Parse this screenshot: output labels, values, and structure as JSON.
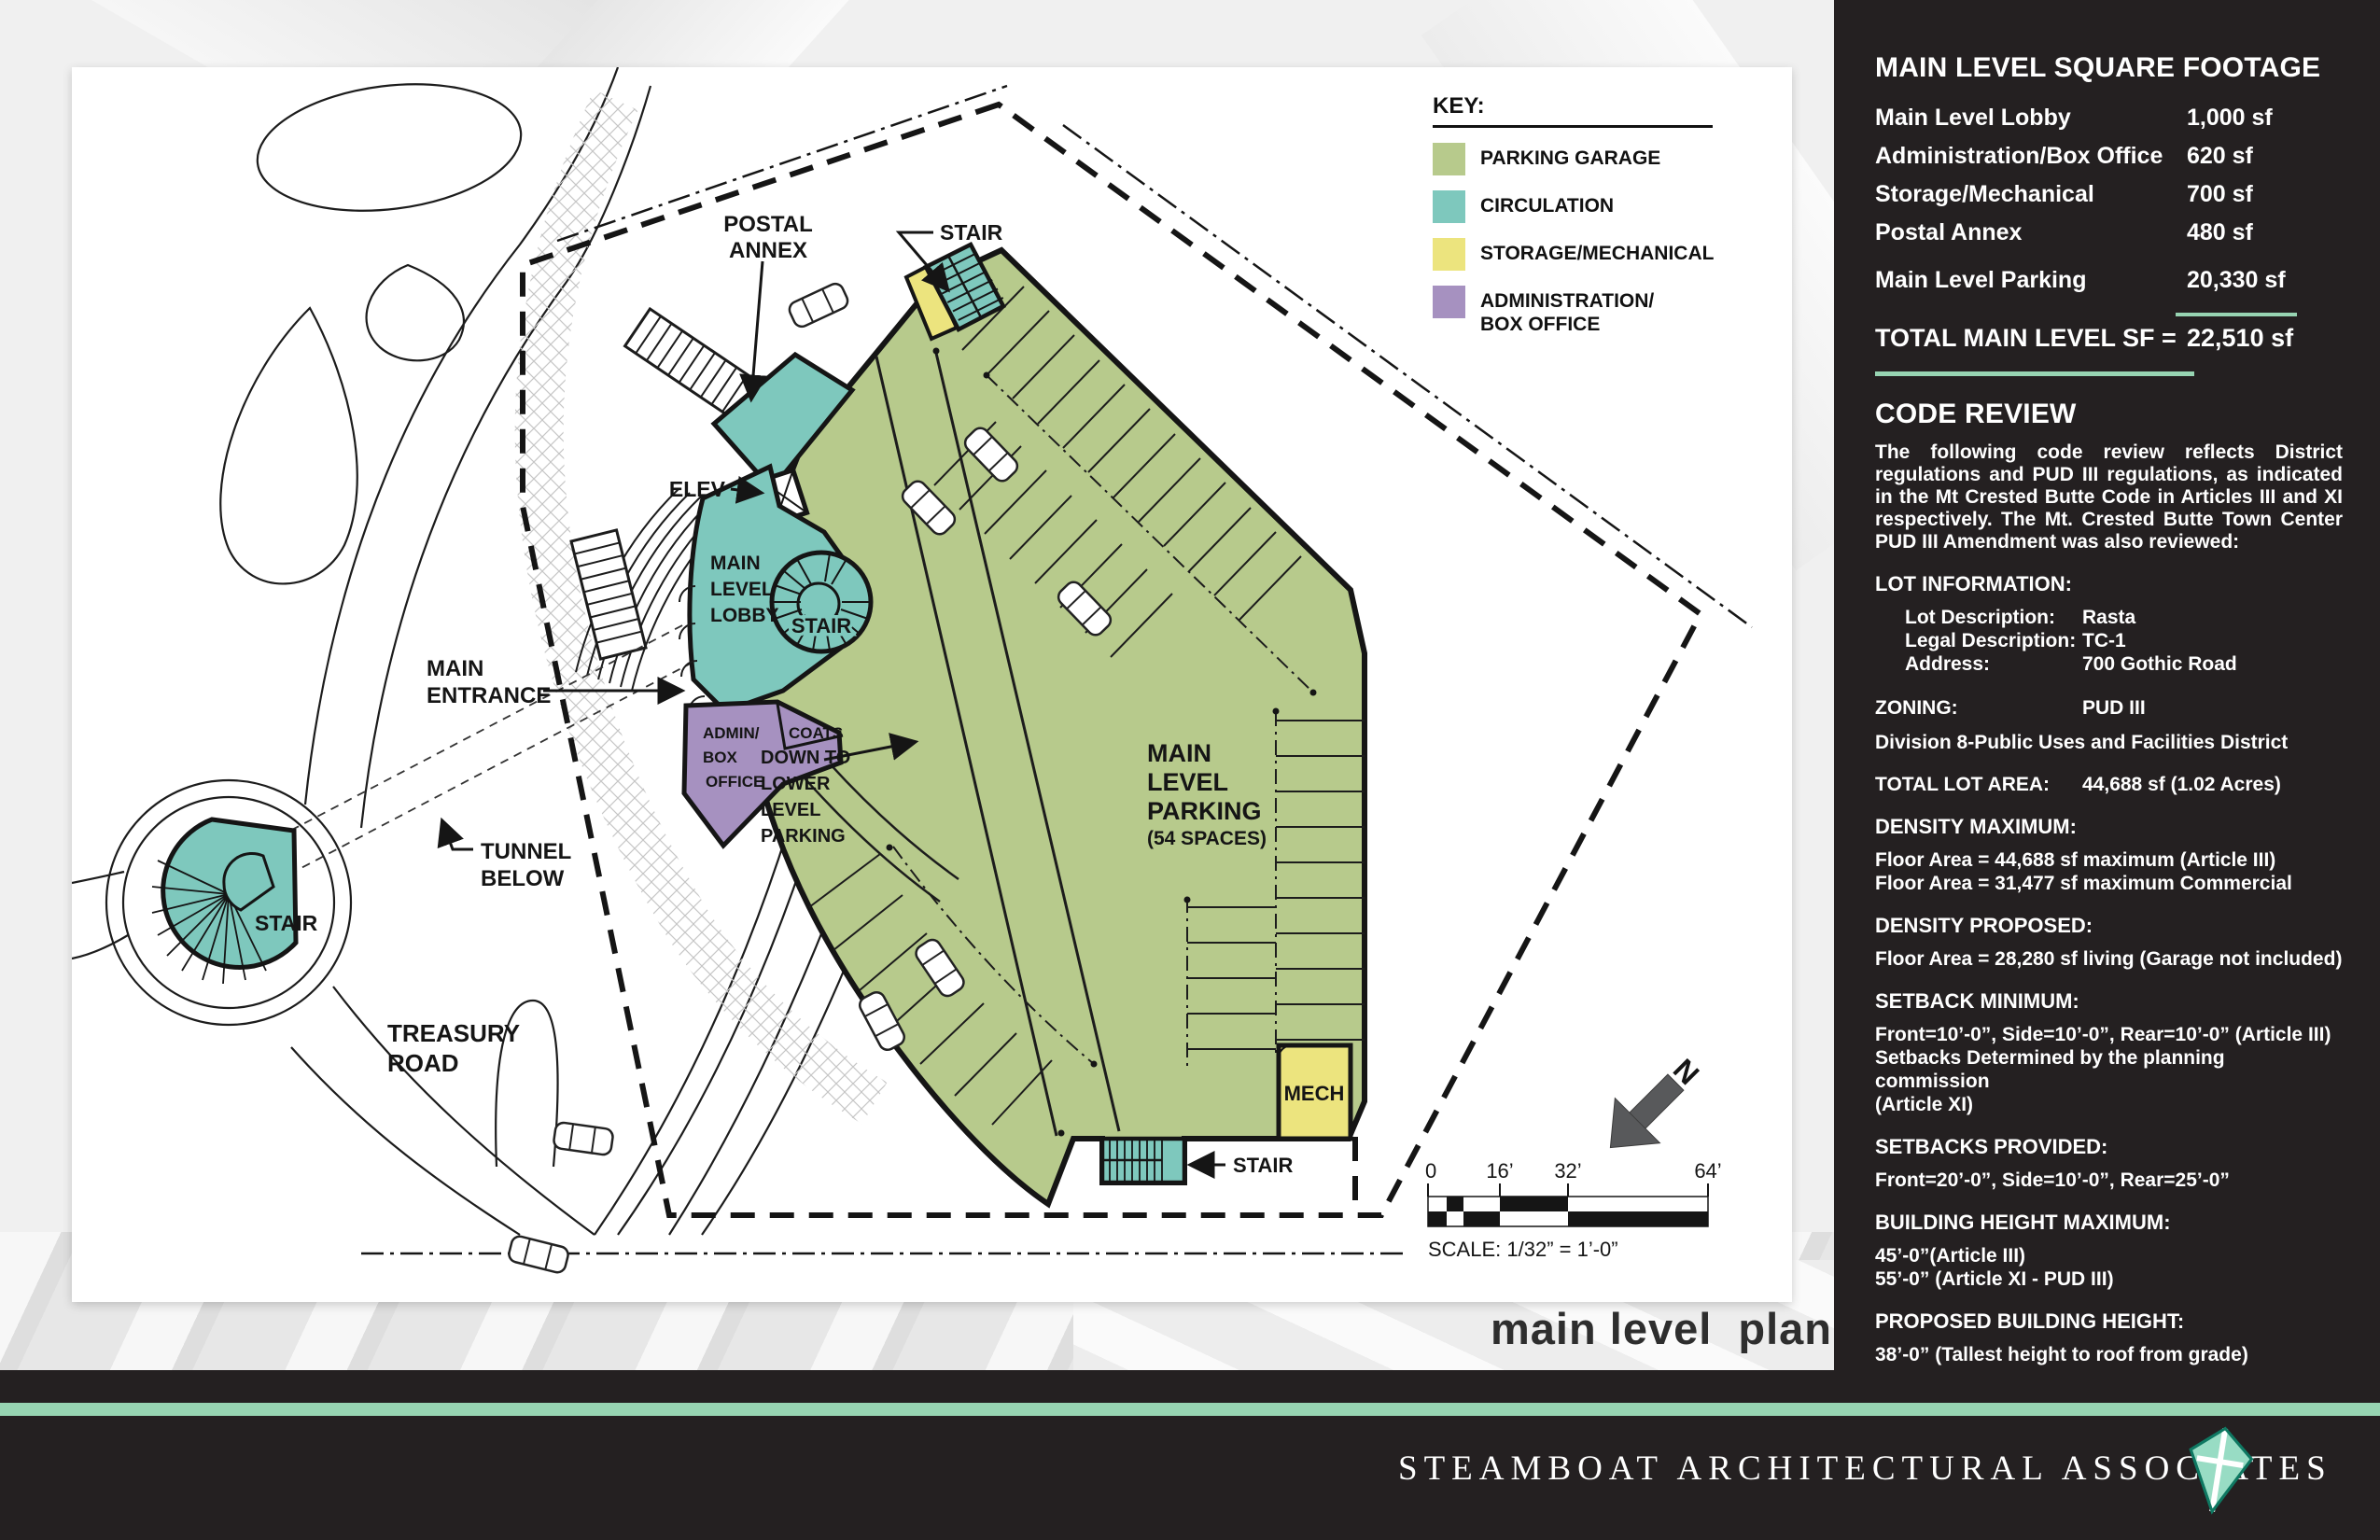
{
  "plan": {
    "key": {
      "title": "KEY:",
      "items": [
        {
          "label": "PARKING GARAGE",
          "color": "#b7ca8c"
        },
        {
          "label": "CIRCULATION",
          "color": "#7ec8bd"
        },
        {
          "label": "STORAGE/MECHANICAL",
          "color": "#ece47e"
        },
        {
          "label": "ADMINISTRATION/",
          "label2": "BOX OFFICE",
          "color": "#a691c0"
        }
      ]
    },
    "labels": {
      "postal_annex": [
        "POSTAL",
        "ANNEX"
      ],
      "stair_top": "STAIR",
      "elev": "ELEV",
      "lobby": [
        "MAIN",
        "LEVEL",
        "LOBBY"
      ],
      "stair_spiral": "STAIR",
      "main_entrance": [
        "MAIN",
        "ENTRANCE"
      ],
      "admin": [
        "ADMIN/",
        "BOX",
        "OFFICE"
      ],
      "coats": "COATS",
      "down_to": [
        "DOWN TO",
        "LOWER",
        "LEVEL",
        "PARKING"
      ],
      "tunnel_below": [
        "TUNNEL",
        "BELOW"
      ],
      "stair_site": "STAIR",
      "treasury_road": [
        "TREASURY",
        "ROAD"
      ],
      "main_parking": [
        "MAIN",
        "LEVEL",
        "PARKING",
        "(54 SPACES)"
      ],
      "mech": "MECH",
      "stair_bottom": "STAIR"
    },
    "scale_bar": {
      "ticks": [
        "0",
        "16’",
        "32’",
        "64’"
      ],
      "label": "SCALE: 1/32” = 1’-0”"
    },
    "north_label": "N",
    "caption": "main level  plan"
  },
  "sidebar": {
    "sqft": {
      "title": "MAIN LEVEL SQUARE FOOTAGE",
      "rows": [
        {
          "label": "Main Level Lobby",
          "value": "1,000 sf"
        },
        {
          "label": "Administration/Box Office",
          "value": "620 sf"
        },
        {
          "label": "Storage/Mechanical",
          "value": "700 sf"
        },
        {
          "label": "Postal Annex",
          "value": "480 sf"
        },
        {
          "label": "Main Level Parking",
          "value": "20,330 sf"
        }
      ],
      "total_label": "TOTAL MAIN LEVEL SF =",
      "total_value": "22,510 sf"
    },
    "code": {
      "title": "CODE REVIEW",
      "intro": "The following code review reflects District regulations and PUD III regulations, as indicated in the Mt Crested Butte Code in Articles III and XI respectively.  The Mt. Crested Butte Town Center PUD III Amendment was also reviewed:",
      "lot_info_heading": "LOT INFORMATION:",
      "lot_info": [
        {
          "label": "Lot Description:",
          "value": "Rasta"
        },
        {
          "label": "Legal Description:",
          "value": "TC-1"
        },
        {
          "label": "Address:",
          "value": "700 Gothic Road"
        }
      ],
      "zoning_label": "ZONING:",
      "zoning_value": "PUD III",
      "zoning_note": "Division 8-Public Uses and Facilities District",
      "lot_area_label": "TOTAL LOT AREA:",
      "lot_area_value": "44,688 sf (1.02 Acres)",
      "sections": [
        {
          "heading": "DENSITY MAXIMUM:",
          "lines": [
            "Floor Area = 44,688 sf maximum (Article III)",
            "Floor Area = 31,477 sf maximum Commercial"
          ]
        },
        {
          "heading": "DENSITY PROPOSED:",
          "lines": [
            "Floor Area  = 28,280 sf living (Garage not included)"
          ]
        },
        {
          "heading": "SETBACK MINIMUM:",
          "lines": [
            "Front=10’-0”, Side=10’-0”, Rear=10’-0” (Article III)",
            "Setbacks Determined by the planning commission",
            "(Article XI)"
          ]
        },
        {
          "heading": "SETBACKS PROVIDED:",
          "lines": [
            "Front=20’-0”, Side=10’-0”, Rear=25’-0”"
          ]
        },
        {
          "heading": "BUILDING HEIGHT MAXIMUM:",
          "lines": [
            "45’-0”(Article III)",
            "55’-0” (Article XI - PUD III)"
          ]
        },
        {
          "heading": "PROPOSED BUILDING HEIGHT:",
          "lines": [
            "38’-0” (Tallest height to roof from grade)"
          ]
        },
        {
          "heading": "PROPOSED PARKING:",
          "lines": [
            "Main Level Parking: 54 spaces",
            "Lower Level Parking 50 spaces (optional)"
          ]
        }
      ]
    }
  },
  "footer": {
    "company": "STEAMBOAT ARCHITECTURAL ASSOCIATES"
  },
  "colors": {
    "accent_mint": "#97d4b2",
    "panel": "#242021",
    "parking": "#b7ca8c",
    "circulation": "#7ec8bd",
    "storage": "#ece47e",
    "admin": "#a691c0"
  }
}
